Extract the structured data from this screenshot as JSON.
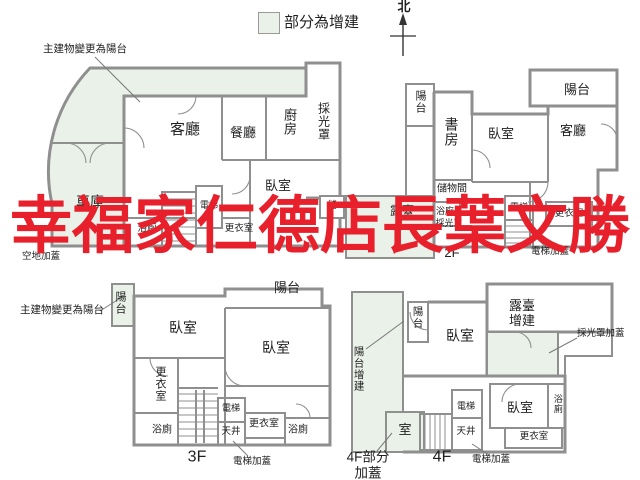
{
  "colors": {
    "addition_fill": "#eaf1e8",
    "wall": "#8f8f8f",
    "watermark_red": "#e8202b"
  },
  "legend": {
    "addition_label": "部分為增建"
  },
  "compass": {
    "north": "北"
  },
  "watermark": {
    "text": "幸福家仁德店長葉文勝"
  },
  "plan_1f": {
    "balcony_note": "主建物變更為陽台",
    "vacant_note": "空地加蓋",
    "living": "客廳",
    "dining": "餐廳",
    "kitchen": "廚房",
    "skylight": "採光罩",
    "bedroom": "臥室",
    "garage": "車庫",
    "elevator": "電梯",
    "bathroom": "浴廁",
    "closet": "更衣室",
    "storage": "儲"
  },
  "plan_2f": {
    "floor": "2F",
    "balcony_left": "陽台",
    "study": "書房",
    "bedroom": "臥室",
    "living": "客廳",
    "balcony_right": "陽台",
    "storage_room": "儲物間",
    "terrace": "露臺",
    "skylight": "採光罩",
    "bathroom": "浴廁",
    "elevator": "電梯",
    "closet": "更衣室",
    "elevator_cover": "電梯加蓋"
  },
  "plan_3f": {
    "floor": "3F",
    "balcony_note": "主建物變更為陽台",
    "balcony_left": "陽台",
    "balcony_top": "陽台",
    "bedroom_left": "臥室",
    "bedroom_right": "臥室",
    "closet_left": "更衣室",
    "bath_left": "浴廁",
    "elevator": "電梯",
    "lightwell": "天井",
    "closet_right": "更衣室",
    "bath_right": "浴廁",
    "elevator_cover": "電梯加蓋"
  },
  "plan_4f": {
    "floor": "4F",
    "balcony_addition": "陽台增建",
    "balcony": "陽台",
    "bedroom_top": "臥室",
    "terrace_addition": "露臺增建",
    "skylight_cover": "採光罩加蓋",
    "bedroom_bottom": "臥室",
    "bath": "浴廁",
    "closet": "更衣室",
    "elevator": "電梯",
    "lightwell": "天井",
    "room": "室",
    "elevator_cover": "電梯加蓋",
    "partial_cover": "4F部分加蓋"
  }
}
